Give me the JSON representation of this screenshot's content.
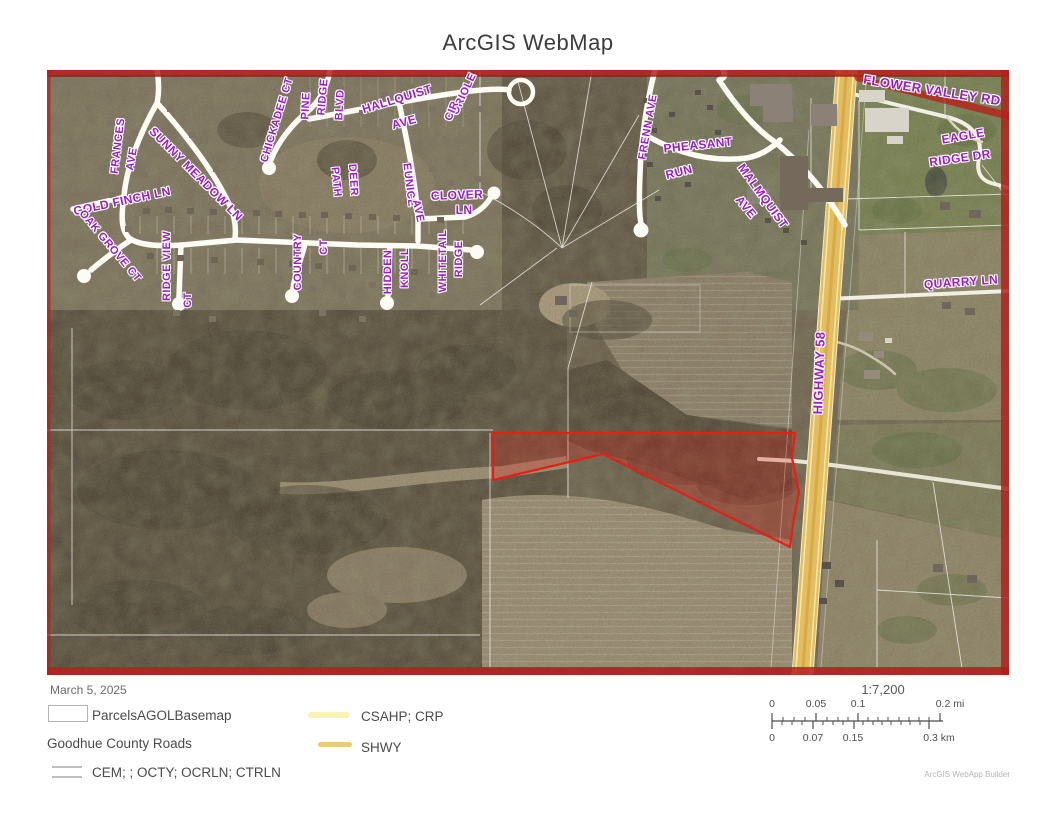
{
  "title": "ArcGIS WebMap",
  "date": "March 5, 2025",
  "map": {
    "label_color": "#9C1BC9",
    "boundary_color": "#B6201B",
    "highlight_parcel_color": "#E81E14",
    "highway_color": "#E2BD62",
    "street_labels": [
      {
        "text": "FLOWER VALLEY RD",
        "x": 885,
        "y": 20,
        "rot": 9,
        "s": 13
      },
      {
        "text": "EAGLE",
        "x": 916,
        "y": 66,
        "rot": -10,
        "s": 12
      },
      {
        "text": "RIDGE DR",
        "x": 913,
        "y": 88,
        "rot": -8,
        "s": 12
      },
      {
        "text": "QUARRY LN",
        "x": 914,
        "y": 212,
        "rot": -4,
        "s": 12
      },
      {
        "text": "HIGHWAY 58",
        "x": 772,
        "y": 303,
        "rot": -88,
        "s": 13
      },
      {
        "text": "FRENN AVE",
        "x": 601,
        "y": 57,
        "rot": -80,
        "s": 11
      },
      {
        "text": "PHEASANT",
        "x": 651,
        "y": 75,
        "rot": -6,
        "s": 12
      },
      {
        "text": "RUN",
        "x": 632,
        "y": 102,
        "rot": -14,
        "s": 12
      },
      {
        "text": "MALMQUIST",
        "x": 716,
        "y": 126,
        "rot": 54,
        "s": 12
      },
      {
        "text": "AVE",
        "x": 699,
        "y": 137,
        "rot": 50,
        "s": 12
      },
      {
        "text": "FRANCES",
        "x": 71,
        "y": 76,
        "rot": -83,
        "s": 11
      },
      {
        "text": "AVE",
        "x": 85,
        "y": 89,
        "rot": -80,
        "s": 11
      },
      {
        "text": "SUNNY MEADOW LN",
        "x": 149,
        "y": 104,
        "rot": 45,
        "s": 12
      },
      {
        "text": "GOLD FINCH LN",
        "x": 75,
        "y": 131,
        "rot": -12,
        "s": 12
      },
      {
        "text": "OAK GROVE CT",
        "x": 63,
        "y": 176,
        "rot": 50,
        "s": 11
      },
      {
        "text": "RIDGE VIEW",
        "x": 120,
        "y": 196,
        "rot": -90,
        "s": 11
      },
      {
        "text": "CT",
        "x": 141,
        "y": 230,
        "rot": -90,
        "s": 11
      },
      {
        "text": "CHICKADEE CT",
        "x": 230,
        "y": 50,
        "rot": -73,
        "s": 11
      },
      {
        "text": "PINE",
        "x": 259,
        "y": 36,
        "rot": -87,
        "s": 11
      },
      {
        "text": "RIDGE",
        "x": 276,
        "y": 27,
        "rot": -85,
        "s": 11
      },
      {
        "text": "BLVD",
        "x": 293,
        "y": 35,
        "rot": -87,
        "s": 11
      },
      {
        "text": "DEER",
        "x": 306,
        "y": 110,
        "rot": 86,
        "s": 11
      },
      {
        "text": "PATH",
        "x": 289,
        "y": 112,
        "rot": 84,
        "s": 11
      },
      {
        "text": "HALLQUIST",
        "x": 350,
        "y": 29,
        "rot": -17,
        "s": 12
      },
      {
        "text": "AVE",
        "x": 357,
        "y": 52,
        "rot": -15,
        "s": 12
      },
      {
        "text": "ORIOLE",
        "x": 417,
        "y": 24,
        "rot": -65,
        "s": 11
      },
      {
        "text": "CIR",
        "x": 405,
        "y": 41,
        "rot": -67,
        "s": 11
      },
      {
        "text": "EUNICE",
        "x": 362,
        "y": 115,
        "rot": 83,
        "s": 11
      },
      {
        "text": "AVE",
        "x": 371,
        "y": 141,
        "rot": 78,
        "s": 11
      },
      {
        "text": "CLOVER",
        "x": 410,
        "y": 125,
        "rot": -2,
        "s": 12
      },
      {
        "text": "LN",
        "x": 417,
        "y": 140,
        "rot": 0,
        "s": 12
      },
      {
        "text": "COUNTRY",
        "x": 251,
        "y": 192,
        "rot": -90,
        "s": 11
      },
      {
        "text": "CT",
        "x": 277,
        "y": 177,
        "rot": -90,
        "s": 11
      },
      {
        "text": "HIDDEN",
        "x": 341,
        "y": 202,
        "rot": -90,
        "s": 11
      },
      {
        "text": "KNOLL",
        "x": 358,
        "y": 198,
        "rot": -90,
        "s": 11
      },
      {
        "text": "WHITETAIL",
        "x": 396,
        "y": 191,
        "rot": -90,
        "s": 11
      },
      {
        "text": "RIDGE",
        "x": 412,
        "y": 189,
        "rot": -90,
        "s": 11
      }
    ]
  },
  "legend": {
    "parcels_label": "ParcelsAGOLBasemap",
    "roads_heading": "Goodhue County Roads",
    "cem_label": "CEM;  ; OCTY; OCRLN; CTRLN",
    "csahp_label": "CSAHP; CRP",
    "shwy_label": "SHWY",
    "csahp_color": "#F7F3B5",
    "shwy_color": "#F2C779",
    "cem_color": "#BDBDBD"
  },
  "scalebar": {
    "ratio": "1:7,200",
    "mi": [
      "0",
      "0.05",
      "0.1",
      "0.2 mi"
    ],
    "km": [
      "0",
      "0.07",
      "0.15",
      "0.3 km"
    ]
  },
  "attribution": "ArcGIS WebApp Builder"
}
